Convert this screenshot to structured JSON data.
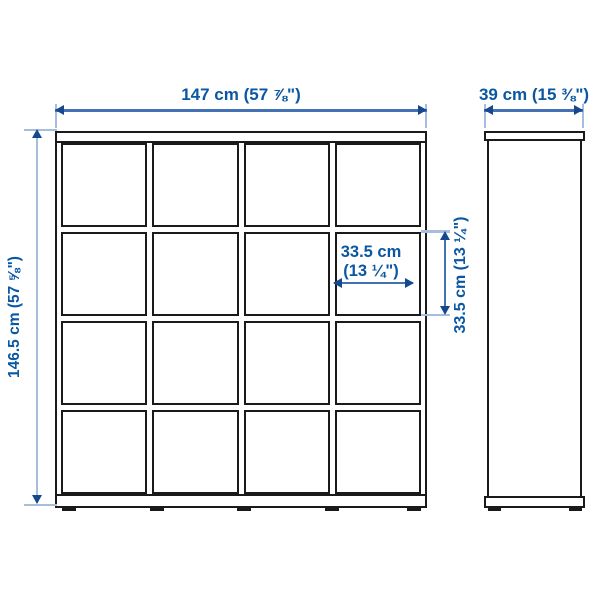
{
  "diagram": {
    "type": "product-dimension-drawing",
    "product": "cube storage shelf unit, 4x4 compartments, front and side views",
    "front_view": {
      "grid_rows": 4,
      "grid_cols": 4,
      "feet_count": 5
    },
    "side_view": {
      "feet_count": 2
    }
  },
  "annotations": {
    "overall_width": {
      "text": "147 cm (57 ⅞\")"
    },
    "depth": {
      "text": "39 cm (15 ⅜\")"
    },
    "overall_height": {
      "text": "146.5 cm (57 ⅝\")"
    },
    "cell_width": {
      "line1": "33.5 cm",
      "line2": "(13 ¼\")"
    },
    "cell_height": {
      "text": "33.5 cm (13 ¼\")"
    }
  },
  "colors": {
    "outline": "#1a1a1a",
    "dim-text": "#0a57a3",
    "dim-line": "#4470b5",
    "dim-arrow": "#16488f",
    "ext-line": "#a6bedd"
  }
}
